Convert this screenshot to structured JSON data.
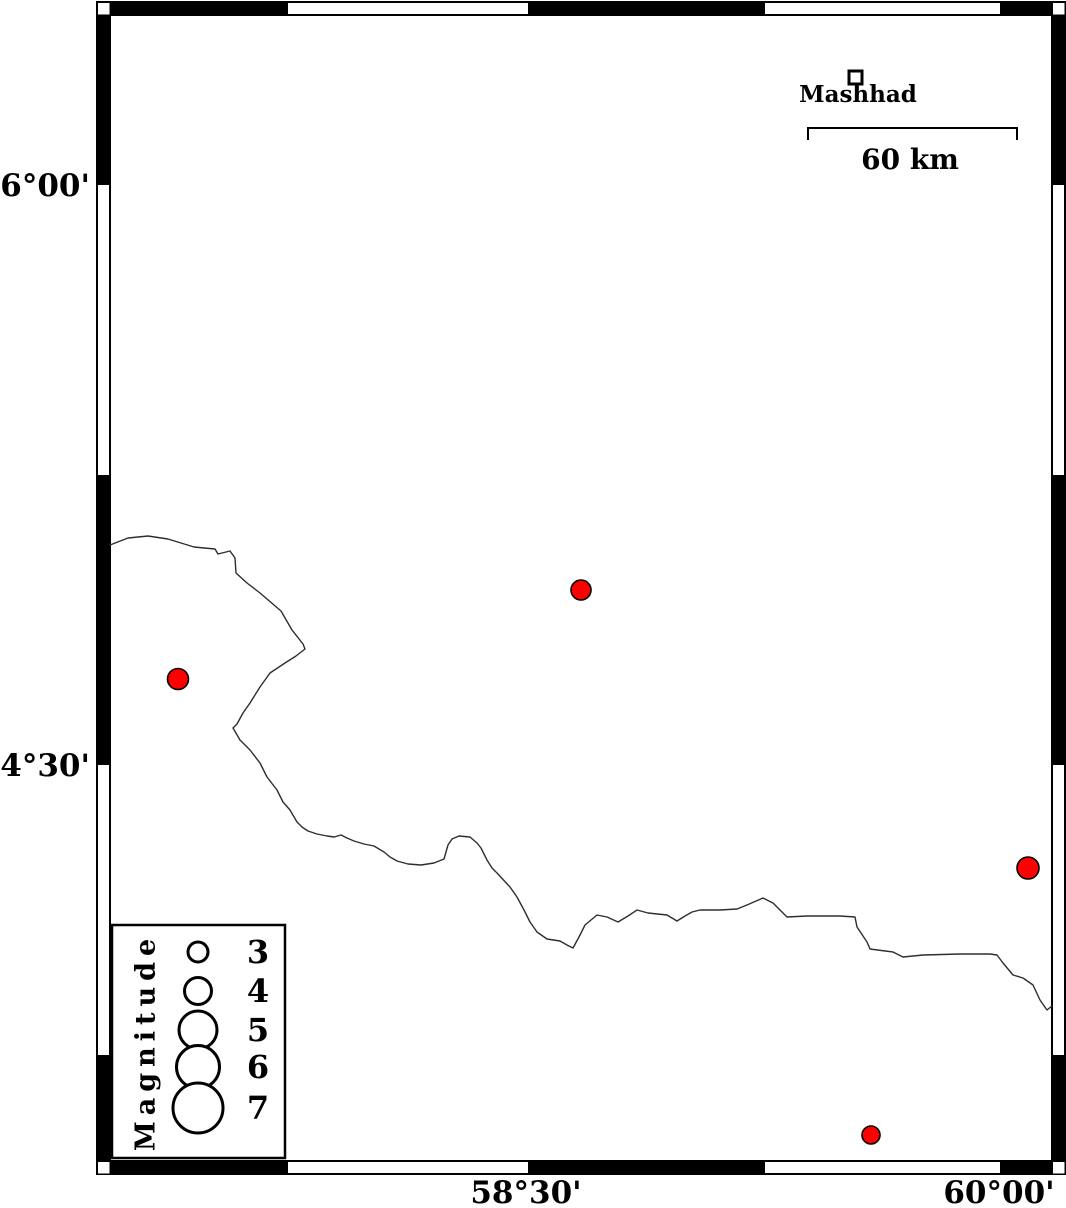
{
  "map": {
    "lat_labels": [
      {
        "text": "36°00'",
        "x": 90,
        "y": 186
      },
      {
        "text": "34°30'",
        "x": 90,
        "y": 766
      }
    ],
    "lon_labels": [
      {
        "text": "58°30'",
        "x": 526,
        "y": 1193
      },
      {
        "text": "60°00'",
        "x": 999,
        "y": 1193
      }
    ],
    "city": {
      "name": "Mashhad",
      "marker_x": 849,
      "marker_y": 71,
      "marker_size": 13,
      "label_x": 858,
      "label_y": 102
    },
    "scale_bar": {
      "label": "60 km",
      "x1": 808,
      "x2": 1017,
      "y": 128,
      "tick_drop": 12,
      "label_x": 910,
      "label_y": 169
    },
    "epicenter_color": "#ff0000",
    "epicenters": [
      {
        "x": 178,
        "y": 679,
        "r": 10.5
      },
      {
        "x": 581,
        "y": 590,
        "r": 10
      },
      {
        "x": 1028,
        "y": 868,
        "r": 11
      },
      {
        "x": 871,
        "y": 1135,
        "r": 9
      }
    ],
    "border_line": {
      "points": [
        [
          110,
          545
        ],
        [
          128,
          538
        ],
        [
          148,
          536
        ],
        [
          168,
          539
        ],
        [
          194,
          547
        ],
        [
          215,
          549
        ],
        [
          218,
          554
        ],
        [
          230,
          551
        ],
        [
          235,
          558
        ],
        [
          236,
          573
        ],
        [
          247,
          583
        ],
        [
          260,
          593
        ],
        [
          281,
          611
        ],
        [
          292,
          630
        ],
        [
          303,
          644
        ],
        [
          305,
          649
        ],
        [
          296,
          656
        ],
        [
          285,
          663
        ],
        [
          270,
          673
        ],
        [
          260,
          687
        ],
        [
          250,
          703
        ],
        [
          243,
          713
        ],
        [
          237,
          724
        ],
        [
          233,
          728
        ],
        [
          240,
          740
        ],
        [
          250,
          750
        ],
        [
          260,
          763
        ],
        [
          267,
          777
        ],
        [
          277,
          790
        ],
        [
          283,
          802
        ],
        [
          290,
          810
        ],
        [
          297,
          822
        ],
        [
          302,
          827
        ],
        [
          308,
          831
        ],
        [
          317,
          834
        ],
        [
          327,
          836
        ],
        [
          334,
          837
        ],
        [
          341,
          835
        ],
        [
          347,
          838
        ],
        [
          354,
          841
        ],
        [
          364,
          844
        ],
        [
          374,
          846
        ],
        [
          384,
          852
        ],
        [
          390,
          857
        ],
        [
          397,
          861
        ],
        [
          408,
          864
        ],
        [
          421,
          865
        ],
        [
          434,
          863
        ],
        [
          444,
          859
        ],
        [
          448,
          845
        ],
        [
          452,
          839
        ],
        [
          459,
          836
        ],
        [
          470,
          837
        ],
        [
          477,
          843
        ],
        [
          481,
          848
        ],
        [
          487,
          860
        ],
        [
          492,
          868
        ],
        [
          497,
          873
        ],
        [
          510,
          887
        ],
        [
          517,
          897
        ],
        [
          524,
          910
        ],
        [
          530,
          922
        ],
        [
          537,
          932
        ],
        [
          547,
          939
        ],
        [
          560,
          941
        ],
        [
          567,
          945
        ],
        [
          573,
          948
        ],
        [
          579,
          937
        ],
        [
          585,
          925
        ],
        [
          597,
          915
        ],
        [
          607,
          917
        ],
        [
          618,
          922
        ],
        [
          628,
          916
        ],
        [
          637,
          910
        ],
        [
          648,
          913
        ],
        [
          667,
          915
        ],
        [
          677,
          921
        ],
        [
          685,
          916
        ],
        [
          692,
          912
        ],
        [
          700,
          910
        ],
        [
          720,
          910
        ],
        [
          737,
          909
        ],
        [
          747,
          905
        ],
        [
          763,
          898
        ],
        [
          773,
          903
        ],
        [
          780,
          910
        ],
        [
          787,
          917
        ],
        [
          807,
          916
        ],
        [
          840,
          916
        ],
        [
          855,
          917
        ],
        [
          857,
          927
        ],
        [
          867,
          942
        ],
        [
          870,
          949
        ],
        [
          893,
          952
        ],
        [
          903,
          957
        ],
        [
          923,
          955
        ],
        [
          960,
          954
        ],
        [
          990,
          954
        ],
        [
          997,
          955
        ],
        [
          1003,
          963
        ],
        [
          1013,
          975
        ],
        [
          1023,
          978
        ],
        [
          1033,
          985
        ],
        [
          1040,
          1000
        ],
        [
          1047,
          1010
        ],
        [
          1052,
          1006
        ]
      ]
    }
  },
  "legend": {
    "title": "Magnitude",
    "circle_x": 198,
    "label_x": 258,
    "entries": [
      {
        "label": "3",
        "r": 10,
        "cy": 952
      },
      {
        "label": "4",
        "r": 13.5,
        "cy": 991
      },
      {
        "label": "5",
        "r": 19,
        "cy": 1030
      },
      {
        "label": "6",
        "r": 21.5,
        "cy": 1067
      },
      {
        "label": "7",
        "r": 25,
        "cy": 1108
      }
    ]
  }
}
